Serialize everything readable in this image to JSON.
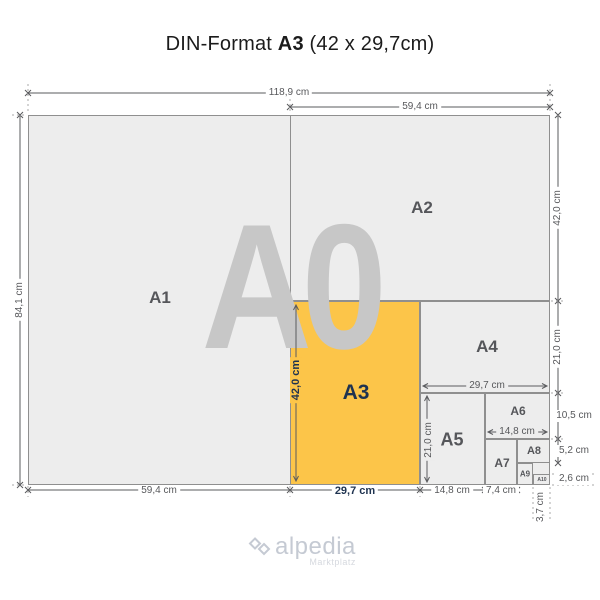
{
  "title": {
    "prefix": "DIN-Format",
    "highlight": "A3",
    "suffix": "(42 x 29,7cm)"
  },
  "watermark": "A0",
  "formats": {
    "a1": {
      "label": "A1"
    },
    "a2": {
      "label": "A2"
    },
    "a3": {
      "label": "A3"
    },
    "a4": {
      "label": "A4"
    },
    "a5": {
      "label": "A5"
    },
    "a6": {
      "label": "A6"
    },
    "a7": {
      "label": "A7"
    },
    "a8": {
      "label": "A8"
    },
    "a9": {
      "label": "A9"
    },
    "a10": {
      "label": "A10"
    }
  },
  "dimensions": {
    "total_width": "118,9 cm",
    "half_width": "59,4 cm",
    "total_height": "84,1 cm",
    "a2_height": "42,0 cm",
    "a4_height": "21,0 cm",
    "a6_height": "10,5 cm",
    "a8_height": "5,2 cm",
    "a10_height": "2,6 cm",
    "a1_width": "59,4 cm",
    "a3_width": "29,7 cm",
    "a5_width": "14,8 cm",
    "a7_width": "7,4 cm",
    "a9_width": "3,7 cm",
    "a3_height": "42,0 cm",
    "a4_width": "29,7 cm",
    "a5_height": "21,0 cm",
    "a6_width": "14,8 cm"
  },
  "logo": {
    "name": "alpedia",
    "tagline": "Marktplatz"
  },
  "colors": {
    "highlight": "#FCC549",
    "navy": "#1F3350",
    "paper": "#EDEDED",
    "border": "#8F8F8F",
    "label_gray": "#55565A",
    "dim_text": "#57585B",
    "watermark": "#C7C7C7",
    "logo": "#C5CAD3"
  }
}
